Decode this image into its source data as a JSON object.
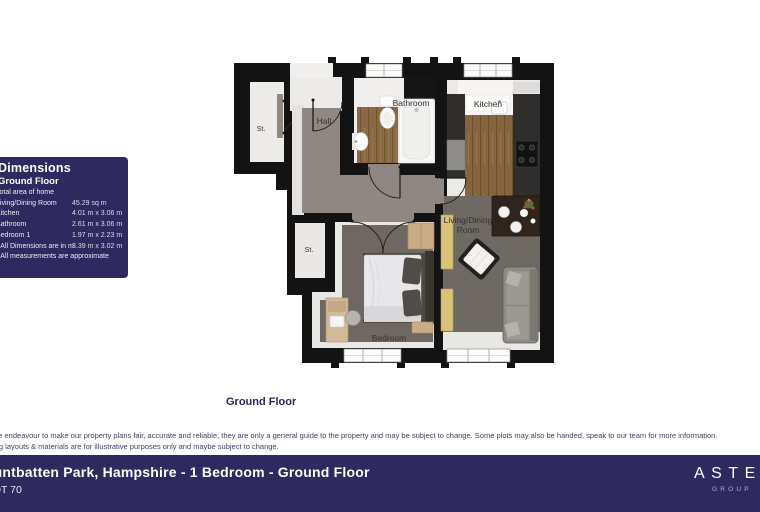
{
  "dimensions_panel": {
    "title": "Dimensions",
    "subtitle": "Ground Floor",
    "labels": [
      "Total area of home",
      "Living/Dining Room",
      "Kitchen",
      "Bathroom",
      "Bedroom 1",
      "* All Dimensions are in m",
      "* All measurements are approximate"
    ],
    "values": [
      "45.29 sq m",
      "4.01 m x 3.06 m",
      "2.61 m x 3.06 m",
      "1.97 m x 2.23 m",
      "3.39 m x 3.02 m"
    ],
    "bg_color": "#2e2a5f"
  },
  "floor_plan": {
    "caption": "Ground Floor",
    "room_labels": {
      "storage_top": "St.",
      "hall": "Hall",
      "bathroom": "Bathroom",
      "kitchen": "Kitchen",
      "living_line1": "Living/Dining",
      "living_line2": "Room",
      "storage_mid": "St.",
      "bedroom": "Bedroom"
    },
    "colors": {
      "wall": "#131313",
      "hall_floor": "#8f8882",
      "dark_floor": "#6f6963",
      "wood_floor": "#8a6a46"
    }
  },
  "disclaimer": {
    "line1": "While we endeavour to make our property plans fair, accurate and reliable, they are only a general guide to the property and may be subject to change. Some plots may also be handed, speak to our team for more information.",
    "line2": "Planting layouts & materials are for illustrative purposes only and maybe subject to change."
  },
  "footer": {
    "title": "Mountbatten Park, Hampshire - 1 Bedroom - Ground Floor",
    "plot": "PLOT 70",
    "logo": "ASTER",
    "logo_sub": "GROUP",
    "bg_color": "#2e2a5f"
  }
}
